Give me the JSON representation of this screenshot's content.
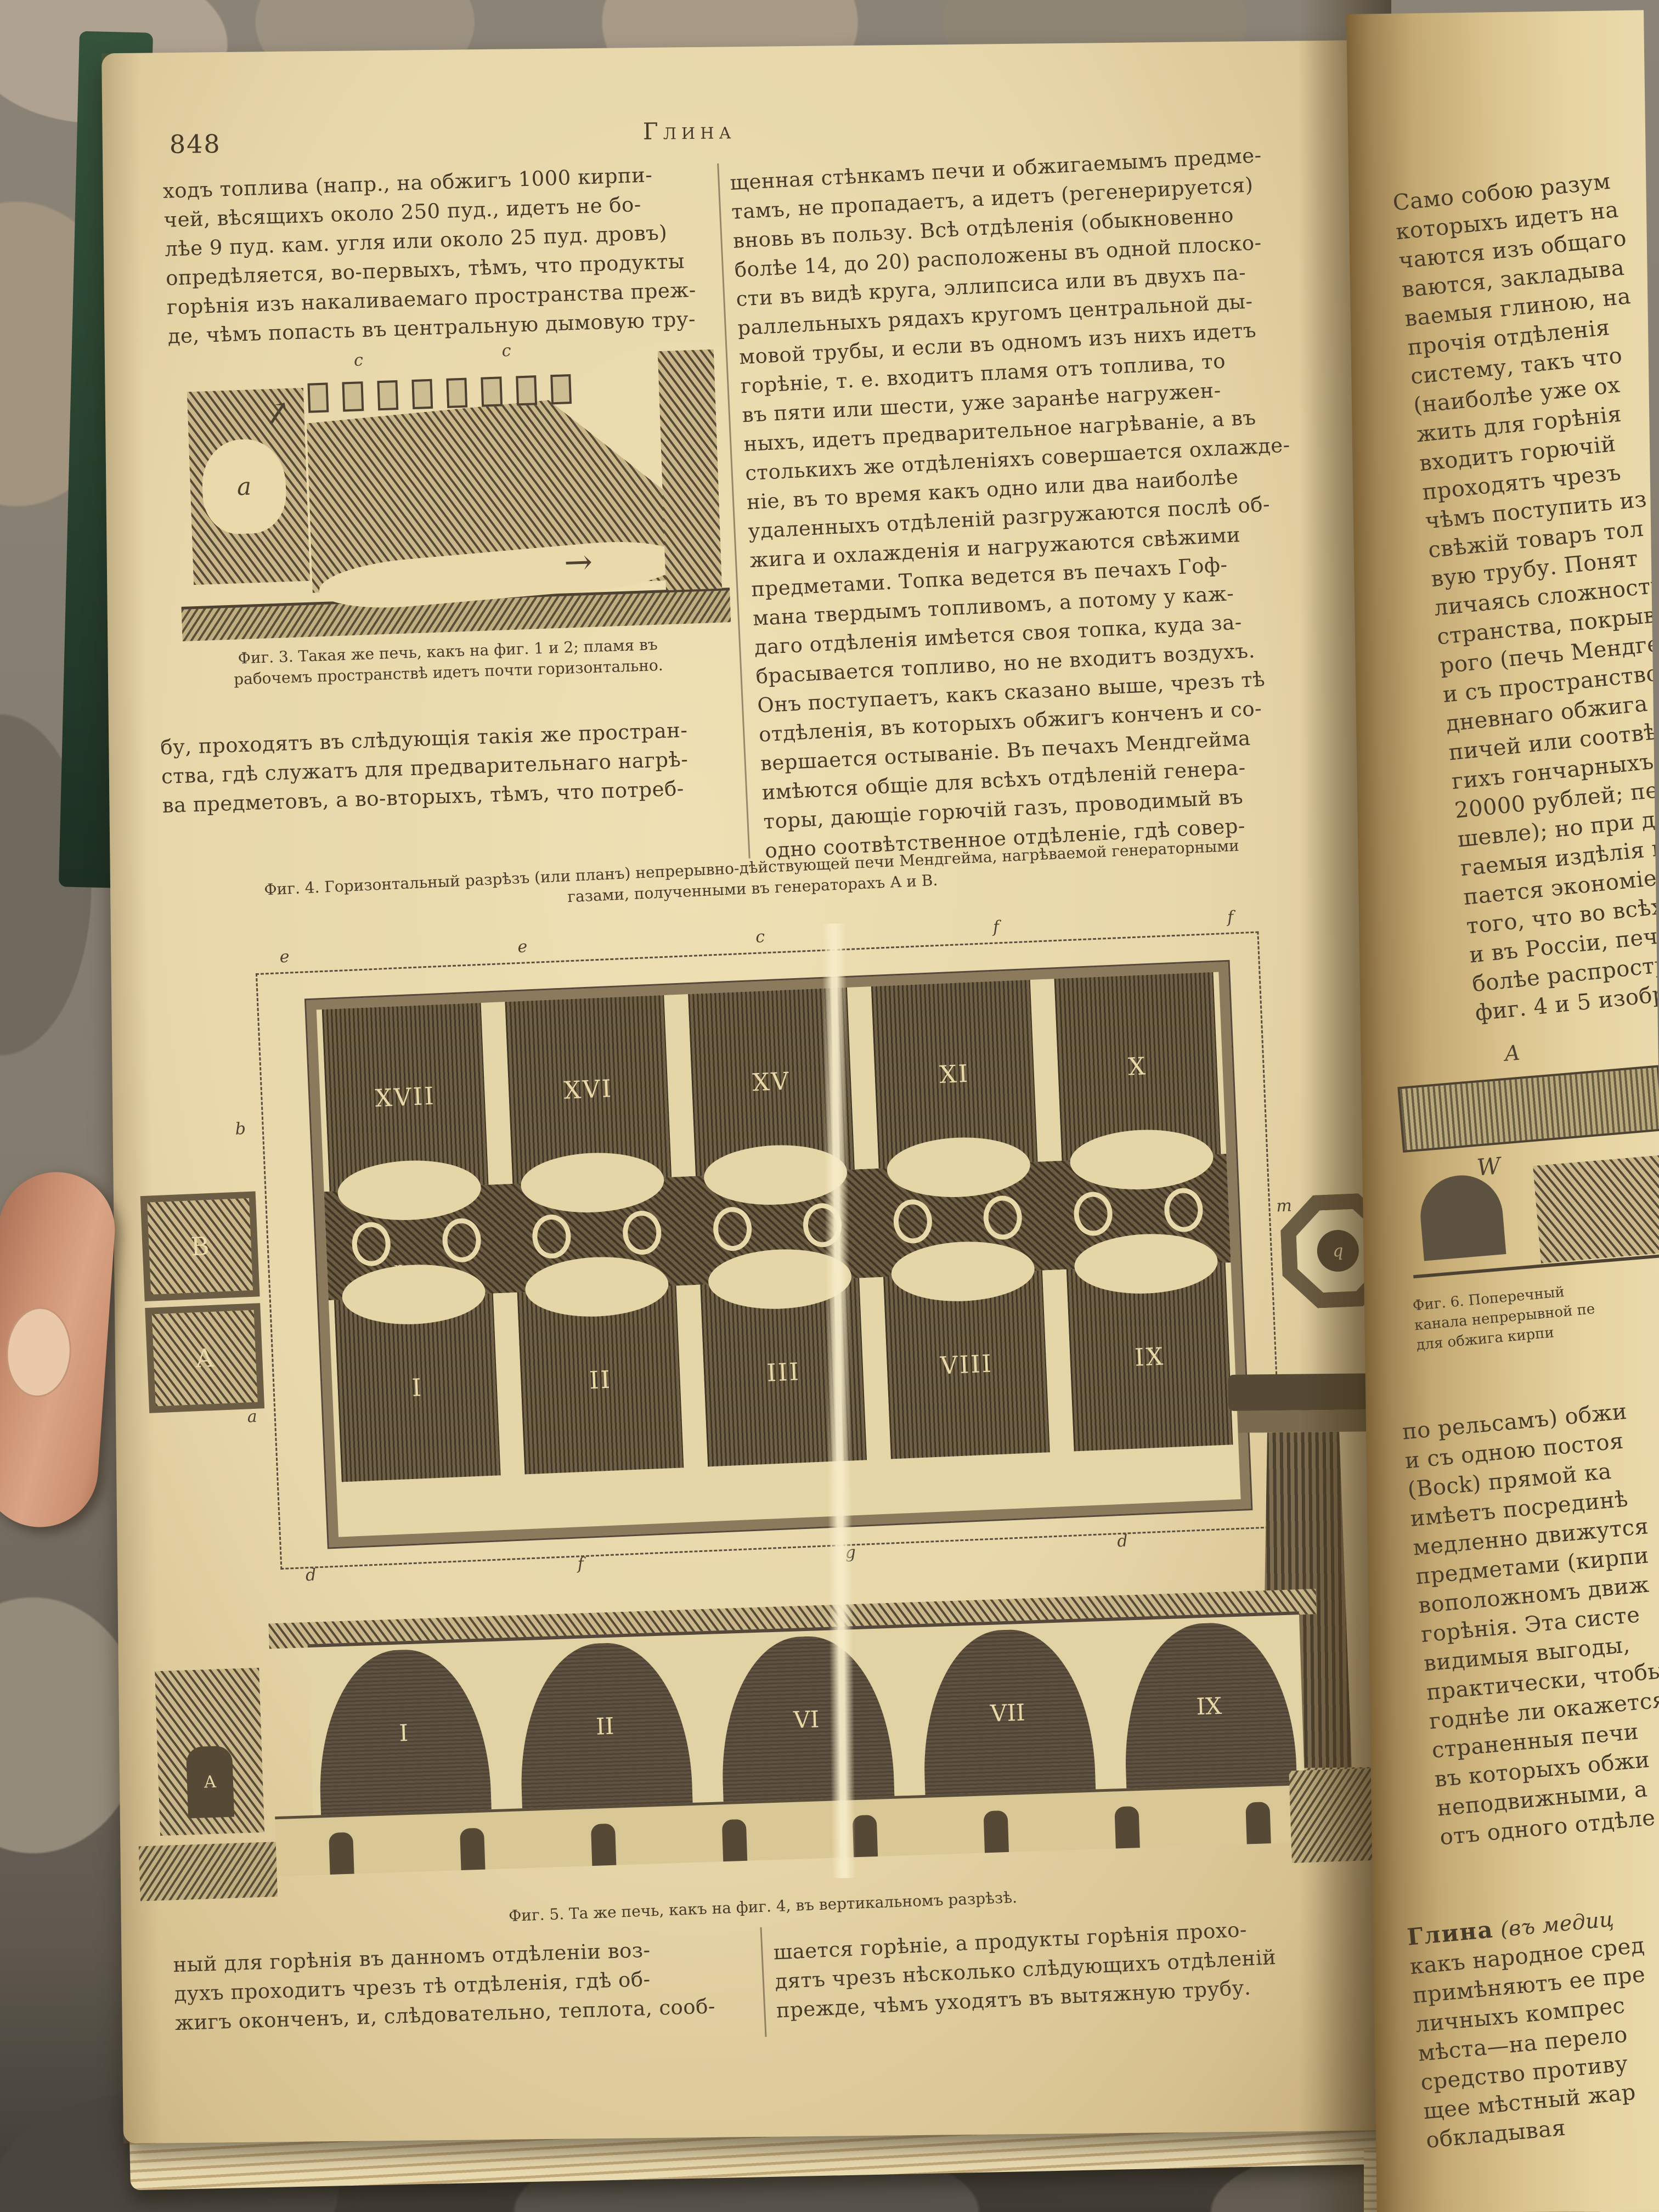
{
  "page": {
    "number": "848",
    "running_title": "Глина"
  },
  "left_column": {
    "para1": [
      "ходъ топлива (напр., на обжигъ 1000 кирпи-",
      "чей, вѣсящихъ около 250 пуд., идетъ не бо-",
      "лѣе 9 пуд. кам. угля или около 25 пуд. дровъ)",
      "опредѣляется, во-первыхъ, тѣмъ, что продукты",
      "горѣнія изъ накаливаемаго пространства преж-",
      "де, чѣмъ попасть въ центральную дымовую тру-"
    ],
    "para2": [
      "бу, проходятъ въ слѣдующія такія же простран-",
      "ства, гдѣ служатъ для предварительнаго нагрѣ-",
      "ва предметовъ, а во-вторыхъ, тѣмъ, что потреб-"
    ]
  },
  "middle_column": {
    "lines": [
      "щенная стѣнкамъ печи и обжигаемымъ предме-",
      "тамъ, не пропадаетъ, а идетъ (регенерируется)",
      "вновь въ пользу. Всѣ отдѣленія (обыкновенно",
      "болѣе 14, до 20) расположены въ одной плоско-",
      "сти въ видѣ круга, эллипсиса или въ двухъ па-",
      "раллельныхъ рядахъ кругомъ центральной ды-",
      "мовой трубы, и если въ одномъ изъ нихъ идетъ",
      "горѣніе, т. е. входитъ пламя отъ топлива, то",
      "въ пяти или шести, уже заранѣе нагружен-",
      "ныхъ, идетъ предварительное нагрѣваніе, а въ",
      "столькихъ же отдѣленіяхъ совершается охлажде-",
      "ніе, въ то время какъ одно или два наиболѣе",
      "удаленныхъ отдѣленій разгружаются послѣ об-",
      "жига и охлажденія и нагружаются свѣжими",
      "предметами. Топка ведется въ печахъ Гоф-",
      "мана твердымъ топливомъ, а потому у каж-",
      "даго отдѣленія имѣется своя топка, куда за-",
      "брасывается топливо, но не входитъ воздухъ.",
      "Онъ поступаетъ, какъ сказано выше, чрезъ тѣ",
      "отдѣленія, въ которыхъ обжигъ конченъ и со-",
      "вершается остываніе. Въ печахъ Мендгейма",
      "имѣются общіе для всѣхъ отдѣленій генера-",
      "торы, дающіе горючій газъ, проводимый въ",
      "одно соотвѣтственное отдѣленіе, гдѣ совер-"
    ]
  },
  "fig3": {
    "caption_lines": [
      "Фиг. 3. Такая же печь, какъ на фиг. 1 и 2; пламя въ",
      "рабочемъ пространствѣ идетъ почти горизонтально."
    ],
    "letters": {
      "c1": "c",
      "c2": "c",
      "chamber": "a"
    }
  },
  "fig4": {
    "caption_lines": [
      "Фиг. 4. Горизонтальный разрѣзъ (или планъ) непрерывно-дѣйствующей печи Мендгейма, нагрѣваемой генераторными",
      "газами, полученными въ генераторахъ А и В."
    ],
    "top_labels": [
      "XVII",
      "XVI",
      "XV",
      "XI",
      "X"
    ],
    "bottom_labels": [
      "I",
      "II",
      "III",
      "VIII",
      "IX"
    ],
    "letters": {
      "top": [
        "e",
        "e",
        "c",
        "f",
        "f"
      ],
      "bottom": [
        "d",
        "f",
        "g",
        "d"
      ],
      "left": [
        "b",
        "l",
        "a"
      ],
      "right": "m",
      "octagon": "q",
      "port": "p"
    },
    "generators": {
      "upper": "В",
      "lower": "А"
    }
  },
  "fig5": {
    "caption": "Фиг. 5. Та же печь, какъ на фиг. 4, въ вертикальномъ разрѣзѣ.",
    "chamber_labels": [
      "I",
      "II",
      "VI",
      "VII",
      "IX"
    ],
    "tower_label": "А"
  },
  "fig6": {
    "caption_lines": [
      "Фиг. 6. Поперечный",
      "канала непрерывной пе",
      "для обжига кирпи"
    ],
    "letters": {
      "a": "A",
      "w": "W",
      "d": "D"
    }
  },
  "bottom_left": {
    "lines": [
      "ный для горѣнія въ данномъ отдѣленіи воз-",
      "духъ проходитъ чрезъ тѣ отдѣленія, гдѣ об-",
      "жигъ оконченъ, и, слѣдовательно, теплота, сооб-"
    ]
  },
  "bottom_middle": {
    "lines": [
      "шается горѣніе, а продукты горѣнія прохо-",
      "дятъ чрезъ нѣсколько слѣдующихъ отдѣленій",
      "прежде, чѣмъ уходятъ въ вытяжную трубу."
    ]
  },
  "right_page": {
    "top_lines": [
      "Само собою разум",
      "которыхъ идетъ на",
      "чаются изъ общаго",
      "ваются, закладыва",
      "ваемыя глиною, на",
      "прочія отдѣленія",
      "систему, такъ что",
      "(наиболѣе уже ох",
      "жить для горѣнія",
      "входитъ горючій",
      "проходятъ чрезъ",
      "чѣмъ поступить из",
      "свѣжій товаръ тол",
      "вую трубу. Понят",
      "личаясь сложность",
      "странства, покрыва",
      "рого (печь Мендге",
      "и съ пространство",
      "дневнаго обжига",
      "пичей или соотвѣт",
      "гихъ гончарныхъ",
      "20000 рублей; печ",
      "шевле); но при дос",
      "гаемыя издѣлія по",
      "пается экономіею",
      "того, что во всѣхъ",
      "и въ Россіи, печи",
      "болѣе распростра",
      "фиг. 4 и 5 изобра"
    ],
    "mid_lines": [
      "по рельсамъ) обжи",
      "и съ одною постоя",
      "(Bock) прямой ка",
      "имѣетъ посрединѣ",
      "медленно движутся",
      "предметами (кирпи",
      "воположномъ движ",
      "горѣнія. Эта систе",
      "видимыя выгоды,",
      "практически, чтобы",
      "годнѣе ли окажется",
      "страненныя печи",
      "въ которыхъ обжи",
      "неподвижными, а",
      "отъ одного отдѣле"
    ],
    "glina_term": "Глина",
    "glina_term_rest": " (въ медиц",
    "glina_lines": [
      "какъ народное сред",
      "примѣняютъ ее пре",
      "личныхъ компрес",
      "мѣста—на перело",
      "средство противу",
      "щее мѣстный жар",
      "обкладывая"
    ]
  }
}
